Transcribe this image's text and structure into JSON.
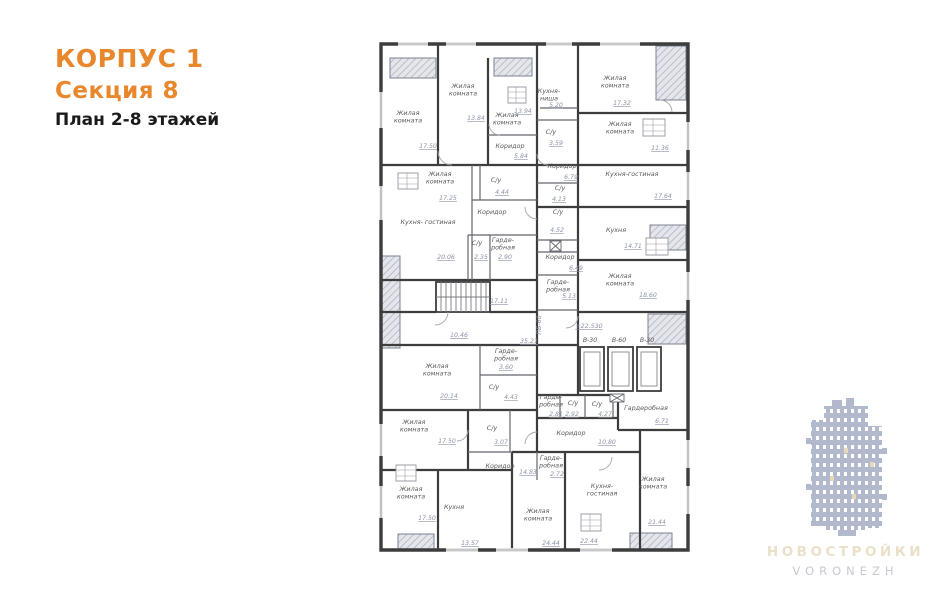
{
  "header": {
    "building": "КОРПУС 1",
    "section": "Секция 8",
    "plan": "План 2-8 этажей"
  },
  "watermark": {
    "title": "НОВОСТРОЙКИ",
    "subtitle": "VORONEZH"
  },
  "colors": {
    "accent": "#e8872b",
    "wall": "#3d3d3d",
    "label_text": "#58595c",
    "area_text": "#8b93a6",
    "watermark_building": "#b3b9cd",
    "watermark_title": "#eae0c8",
    "watermark_subtitle": "#c6c9d2"
  },
  "floorplan": {
    "rooms": [
      {
        "lines": [
          "Жилая",
          "комната"
        ],
        "area": "17.50",
        "lx": 408,
        "ly": 115,
        "ax": 428,
        "ay": 148
      },
      {
        "lines": [
          "Жилая",
          "комната"
        ],
        "area": "13.84",
        "lx": 463,
        "ly": 88,
        "ax": 476,
        "ay": 120
      },
      {
        "lines": [
          "Жилая",
          "комната"
        ],
        "area": "13.94",
        "lx": 507,
        "ly": 117,
        "ax": 523,
        "ay": 113
      },
      {
        "lines": [
          "Коридор"
        ],
        "area": "5.84",
        "lx": 510,
        "ly": 148,
        "ax": 521,
        "ay": 158
      },
      {
        "lines": [
          "Кухня-",
          "ниша"
        ],
        "area": "5.20",
        "lx": 549,
        "ly": 93,
        "ax": 556,
        "ay": 107
      },
      {
        "lines": [
          "Жилая",
          "комната"
        ],
        "area": "17.32",
        "lx": 615,
        "ly": 80,
        "ax": 622,
        "ay": 105
      },
      {
        "lines": [
          "С/у"
        ],
        "area": "3.59",
        "lx": 551,
        "ly": 134,
        "ax": 556,
        "ay": 145
      },
      {
        "lines": [
          "Жилая",
          "комната"
        ],
        "area": "11.36",
        "lx": 620,
        "ly": 126,
        "ax": 660,
        "ay": 150
      },
      {
        "lines": [
          "Коридор"
        ],
        "area": "6.79",
        "lx": 562,
        "ly": 168,
        "ax": 571,
        "ay": 179
      },
      {
        "lines": [
          "Кухня-гостиная"
        ],
        "area": "17.64",
        "lx": 632,
        "ly": 176,
        "ax": 663,
        "ay": 198
      },
      {
        "lines": [
          "Жилая",
          "комната"
        ],
        "area": "17.25",
        "lx": 440,
        "ly": 176,
        "ax": 448,
        "ay": 200
      },
      {
        "lines": [
          "С/у"
        ],
        "area": "4.44",
        "lx": 496,
        "ly": 182,
        "ax": 502,
        "ay": 194
      },
      {
        "lines": [
          "Коридор"
        ],
        "area": "",
        "lx": 492,
        "ly": 214,
        "ax": 0,
        "ay": 0
      },
      {
        "lines": [
          "Кухня- гостиная"
        ],
        "area": "20.06",
        "lx": 428,
        "ly": 224,
        "ax": 446,
        "ay": 259
      },
      {
        "lines": [
          "С/у"
        ],
        "area": "2.35",
        "lx": 477,
        "ly": 245,
        "ax": 481,
        "ay": 259
      },
      {
        "lines": [
          "Гарде-",
          "робная"
        ],
        "area": "2.90",
        "lx": 503,
        "ly": 242,
        "ax": 505,
        "ay": 259
      },
      {
        "lines": [
          "С/у"
        ],
        "area": "4.13",
        "lx": 560,
        "ly": 190,
        "ax": 559,
        "ay": 201
      },
      {
        "lines": [
          "С/у"
        ],
        "area": "4.52",
        "lx": 558,
        "ly": 214,
        "ax": 557,
        "ay": 232
      },
      {
        "lines": [
          "Кухня"
        ],
        "area": "14.71",
        "lx": 616,
        "ly": 232,
        "ax": 633,
        "ay": 248
      },
      {
        "lines": [
          "Коридор"
        ],
        "area": "6.49",
        "lx": 560,
        "ly": 259,
        "ax": 576,
        "ay": 270
      },
      {
        "lines": [
          "Гарде-",
          "робная"
        ],
        "area": "5.13",
        "lx": 558,
        "ly": 284,
        "ax": 569,
        "ay": 298
      },
      {
        "lines": [
          "Жилая",
          "комната"
        ],
        "area": "18.60",
        "lx": 620,
        "ly": 278,
        "ax": 648,
        "ay": 297
      },
      {
        "lines": [
          "Жилая",
          "комната"
        ],
        "area": "20.14",
        "lx": 437,
        "ly": 368,
        "ax": 449,
        "ay": 398
      },
      {
        "lines": [
          "Гарде-",
          "робная"
        ],
        "area": "3.60",
        "lx": 506,
        "ly": 353,
        "ax": 506,
        "ay": 369
      },
      {
        "lines": [
          "С/у"
        ],
        "area": "4.43",
        "lx": 494,
        "ly": 389,
        "ax": 511,
        "ay": 399
      },
      {
        "lines": [
          "Гарде-",
          "робная"
        ],
        "area": "2.81",
        "lx": 551,
        "ly": 399,
        "ax": 556,
        "ay": 416
      },
      {
        "lines": [
          "С/у"
        ],
        "area": "2.92",
        "lx": 573,
        "ly": 405,
        "ax": 572,
        "ay": 416
      },
      {
        "lines": [
          "С/у"
        ],
        "area": "4.27",
        "lx": 597,
        "ly": 406,
        "ax": 605,
        "ay": 416
      },
      {
        "lines": [
          "Гардеробная"
        ],
        "area": "6.71",
        "lx": 646,
        "ly": 410,
        "ax": 662,
        "ay": 423
      },
      {
        "lines": [
          "Коридор"
        ],
        "area": "10.80",
        "lx": 571,
        "ly": 435,
        "ax": 607,
        "ay": 444
      },
      {
        "lines": [
          "Жилая",
          "комната"
        ],
        "area": "17.50",
        "lx": 414,
        "ly": 424,
        "ax": 447,
        "ay": 443
      },
      {
        "lines": [
          "С/у"
        ],
        "area": "3.07",
        "lx": 492,
        "ly": 430,
        "ax": 501,
        "ay": 444
      },
      {
        "lines": [
          "Коридор"
        ],
        "area": "14.83",
        "lx": 500,
        "ly": 468,
        "ax": 528,
        "ay": 474
      },
      {
        "lines": [
          "Жилая",
          "комната"
        ],
        "area": "17.50",
        "lx": 411,
        "ly": 491,
        "ax": 427,
        "ay": 520
      },
      {
        "lines": [
          "Кухня"
        ],
        "area": "13.57",
        "lx": 454,
        "ly": 509,
        "ax": 470,
        "ay": 545
      },
      {
        "lines": [
          "Гарде-",
          "робная"
        ],
        "area": "2.72",
        "lx": 551,
        "ly": 460,
        "ax": 557,
        "ay": 476
      },
      {
        "lines": [
          "Жилая",
          "комната"
        ],
        "area": "24.44",
        "lx": 538,
        "ly": 513,
        "ax": 551,
        "ay": 545
      },
      {
        "lines": [
          "Кухня-",
          "гостиная"
        ],
        "area": "22.44",
        "lx": 602,
        "ly": 488,
        "ax": 589,
        "ay": 543
      },
      {
        "lines": [
          "Жилая",
          "комната"
        ],
        "area": "21.44",
        "lx": 653,
        "ly": 481,
        "ax": 657,
        "ay": 524
      }
    ],
    "elevators": [
      {
        "label": "В-30",
        "x": 590
      },
      {
        "label": "В-60",
        "x": 619
      },
      {
        "label": "В-30",
        "x": 647
      }
    ],
    "elevator_label_y": 342,
    "marks": [
      {
        "text": "+22.530",
        "x": 589,
        "y": 328,
        "vertical": false
      },
      {
        "text": "35.21",
        "x": 529,
        "y": 343,
        "vertical": false
      },
      {
        "text": "10.46",
        "x": 459,
        "y": 337,
        "vertical": false
      },
      {
        "text": "17.11",
        "x": 499,
        "y": 303,
        "vertical": false
      },
      {
        "text": "ПБ-60",
        "x": 541,
        "y": 325,
        "vertical": true
      }
    ]
  }
}
